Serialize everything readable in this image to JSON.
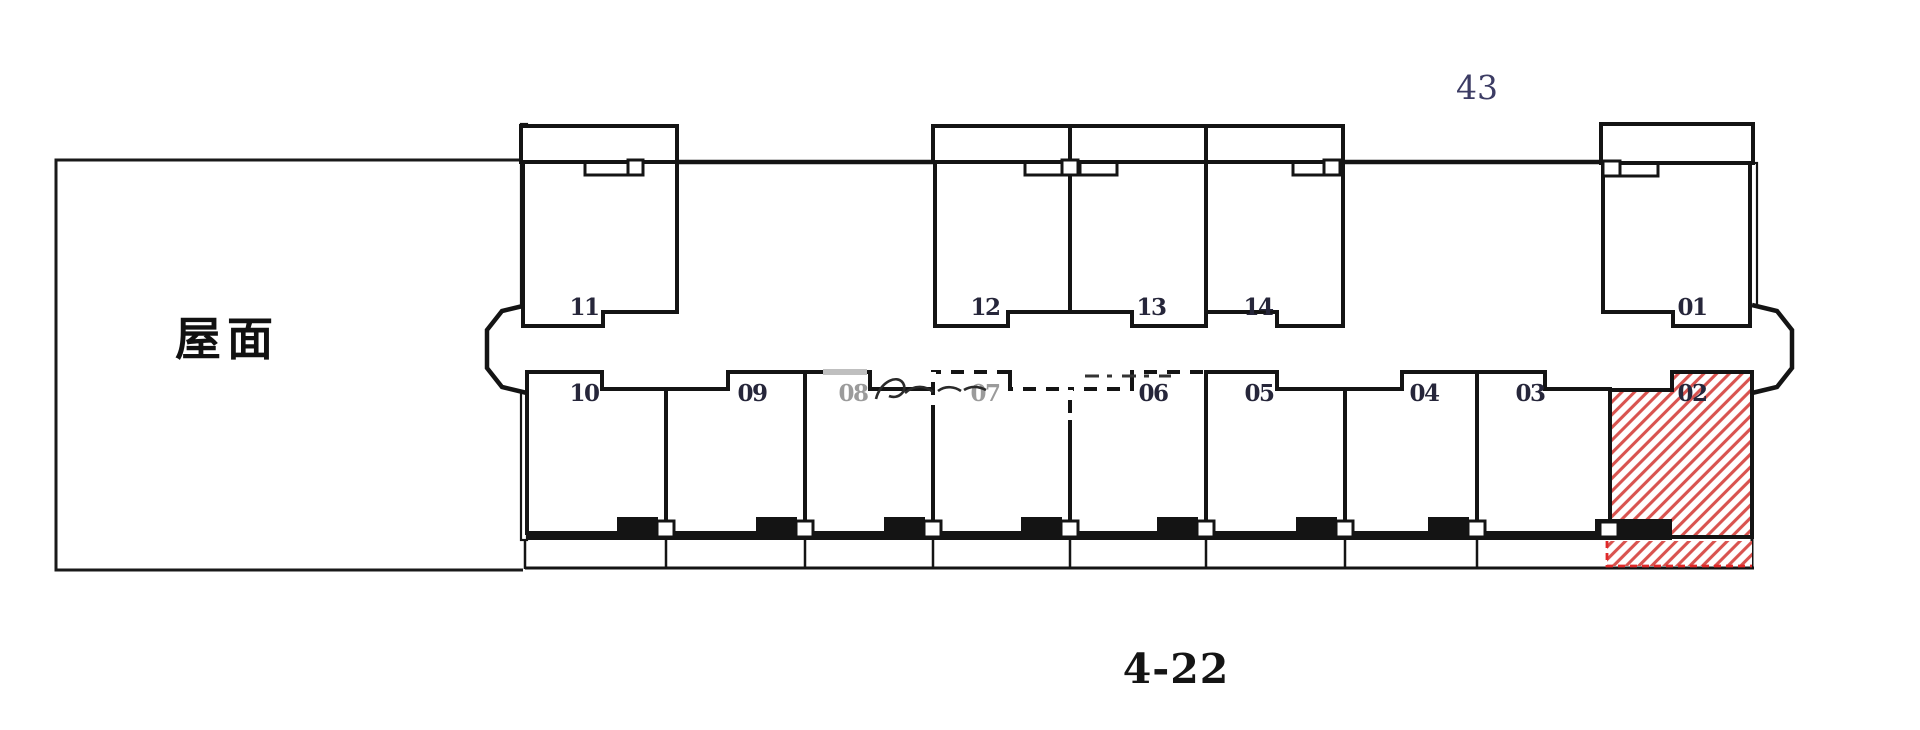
{
  "plan": {
    "number": "43",
    "caption": "4-22"
  },
  "roof": {
    "label": "屋面"
  },
  "top_units": [
    {
      "id": "11",
      "label": "11"
    },
    {
      "id": "12",
      "label": "12"
    },
    {
      "id": "13",
      "label": "13"
    },
    {
      "id": "14",
      "label": "14"
    },
    {
      "id": "01",
      "label": "01"
    }
  ],
  "bottom_units": [
    {
      "id": "10",
      "label": "10"
    },
    {
      "id": "09",
      "label": "09"
    },
    {
      "id": "08",
      "label": "08",
      "faded_by_watermark": true
    },
    {
      "id": "07",
      "label": "07",
      "faded_by_watermark": true
    },
    {
      "id": "06",
      "label": "06"
    },
    {
      "id": "05",
      "label": "05"
    },
    {
      "id": "04",
      "label": "04"
    },
    {
      "id": "03",
      "label": "03"
    },
    {
      "id": "02",
      "label": "02",
      "highlighted": true
    }
  ],
  "colors": {
    "wall": "#141414",
    "hatch_red": "#d9534f",
    "dash_red": "#e02a2a",
    "unit_number": "#26263a",
    "faded_number": "#9b9b9b",
    "plan_number": "#3c3c64",
    "caption": "#141414",
    "watermark": "#bfbfbf"
  }
}
